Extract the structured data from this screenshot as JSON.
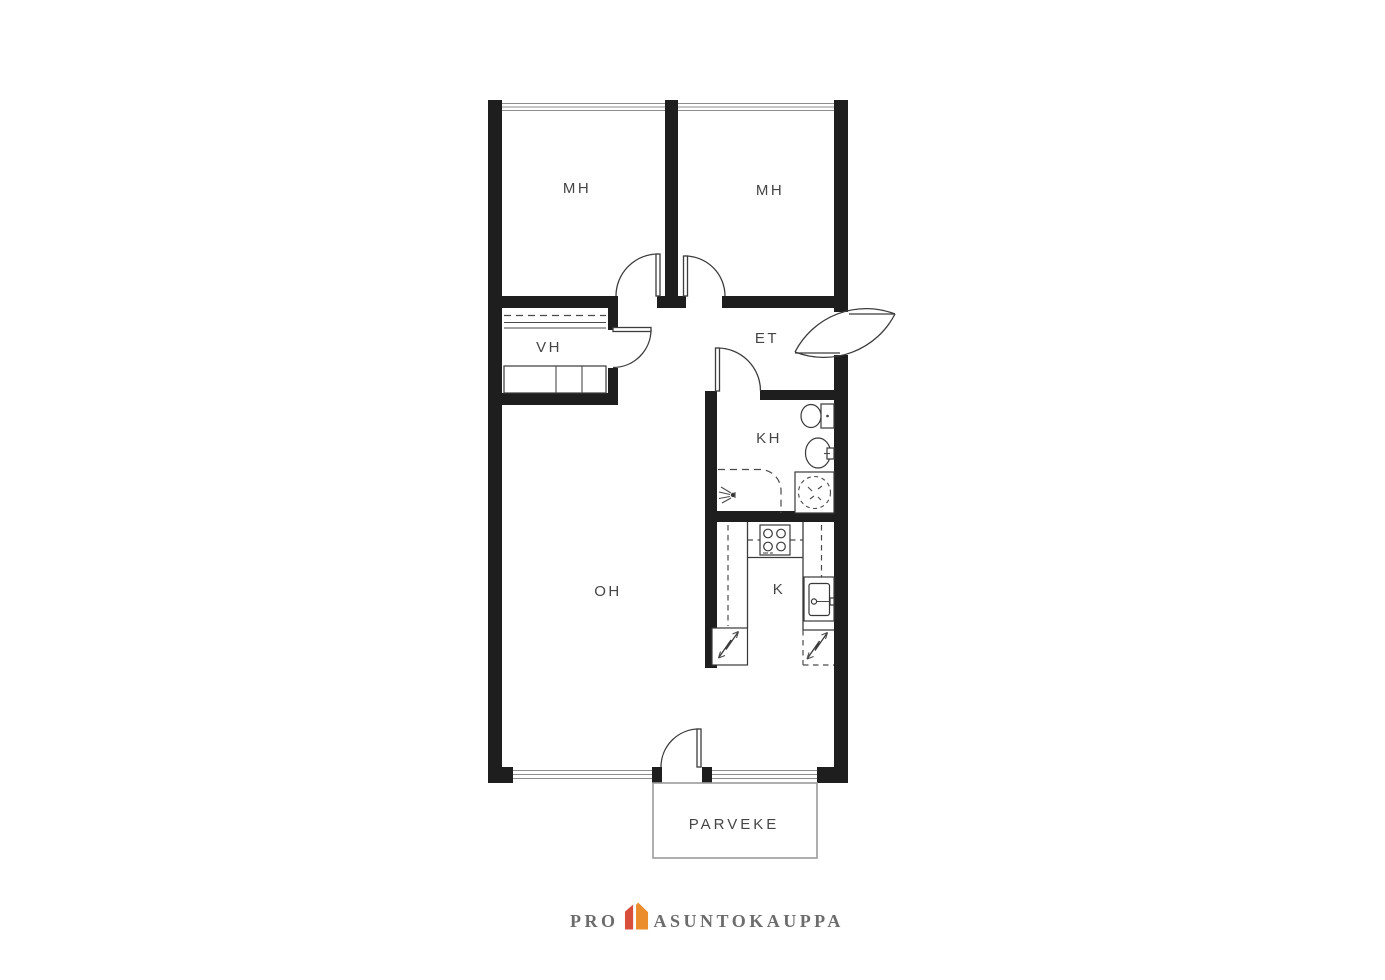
{
  "floor_plan": {
    "rooms": [
      {
        "id": "bedroom-left",
        "label": "MH"
      },
      {
        "id": "bedroom-right",
        "label": "MH"
      },
      {
        "id": "closet",
        "label": "VH"
      },
      {
        "id": "entry-hall",
        "label": "ET"
      },
      {
        "id": "bathroom",
        "label": "KH"
      },
      {
        "id": "kitchen",
        "label": "K"
      },
      {
        "id": "living-room",
        "label": "OH"
      },
      {
        "id": "balcony",
        "label": "PARVEKE"
      }
    ],
    "fixtures": [
      "toilet",
      "washbasin",
      "washing-machine-space",
      "shower",
      "stove",
      "kitchen-sink",
      "refrigerator",
      "freezer",
      "wardrobes",
      "shelf"
    ],
    "colors": {
      "wall": "#1e1e1e",
      "line": "#3c3c3c",
      "window_line": "#8d8d8d",
      "label": "#454545",
      "balcony_border": "#9b9b9b",
      "background": "#ffffff"
    }
  },
  "logo": {
    "word_left": "PRO",
    "word_right": "ASUNTOKAUPPA",
    "icon": "house-icon",
    "colors": {
      "text": "#6c6c6c",
      "house_left": "#d8503c",
      "house_right": "#eb8d2c"
    }
  }
}
